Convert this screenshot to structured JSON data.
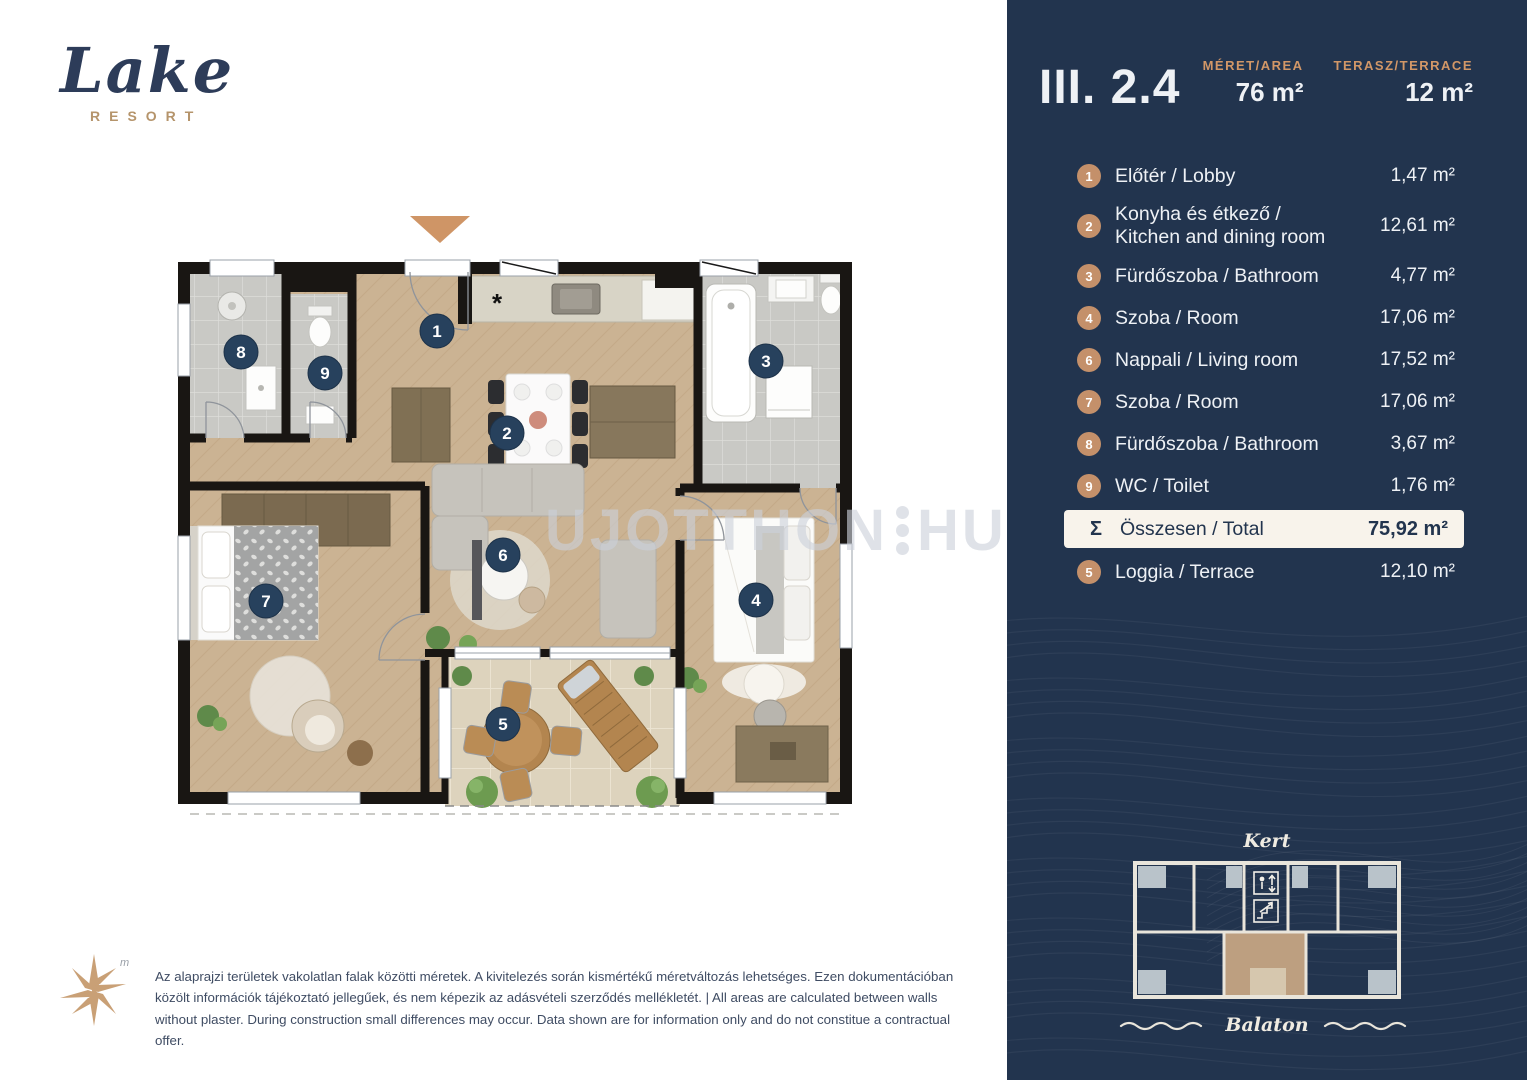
{
  "logo": {
    "name": "Lake",
    "subtitle": "RESORT"
  },
  "unit": {
    "id": "III. 2.4",
    "area_label": "MÉRET/AREA",
    "area_value": "76 m²",
    "terrace_label": "TERASZ/TERRACE",
    "terrace_value": "12 m²"
  },
  "rooms": [
    {
      "num": "1",
      "label": "Előtér / Lobby",
      "value": "1,47 m²"
    },
    {
      "num": "2",
      "label": "Konyha  és étkező /\nKitchen and dining room",
      "value": "12,61 m²",
      "two_line": true
    },
    {
      "num": "3",
      "label": "Fürdőszoba / Bathroom",
      "value": "4,77 m²"
    },
    {
      "num": "4",
      "label": "Szoba / Room",
      "value": "17,06 m²"
    },
    {
      "num": "6",
      "label": "Nappali / Living room",
      "value": "17,52 m²"
    },
    {
      "num": "7",
      "label": "Szoba / Room",
      "value": "17,06 m²"
    },
    {
      "num": "8",
      "label": "Fürdőszoba / Bathroom",
      "value": "3,67 m²"
    },
    {
      "num": "9",
      "label": "WC / Toilet",
      "value": "1,76 m²"
    },
    {
      "num": "Σ",
      "label": "Összesen / Total",
      "value": "75,92 m²",
      "total": true
    },
    {
      "num": "5",
      "label": "Loggia / Terrace",
      "value": "12,10 m²"
    }
  ],
  "floorplan": {
    "badges": [
      {
        "n": "1",
        "x": 267,
        "y": 83
      },
      {
        "n": "2",
        "x": 337,
        "y": 185
      },
      {
        "n": "3",
        "x": 596,
        "y": 113
      },
      {
        "n": "4",
        "x": 586,
        "y": 352
      },
      {
        "n": "5",
        "x": 333,
        "y": 476
      },
      {
        "n": "6",
        "x": 333,
        "y": 307
      },
      {
        "n": "7",
        "x": 96,
        "y": 353
      },
      {
        "n": "8",
        "x": 71,
        "y": 104
      },
      {
        "n": "9",
        "x": 155,
        "y": 125
      }
    ]
  },
  "watermark": {
    "text1": "UJOTTHON",
    "text2": "HU"
  },
  "minimap": {
    "top_label": "Kert",
    "bottom_label": "Balaton"
  },
  "compass": {
    "mark": "m"
  },
  "disclaimer": {
    "text": "Az alaprajzi területek vakolatlan falak közötti méretek. A kivitelezés során kismértékű méretváltozás lehetséges. Ezen dokumentációban közölt információk tájékoztató jellegűek, és nem képezik az adásvételi szerződés mellékletét. | All areas are calculated between walls without plaster. During construction small differences may occur. Data shown are for information only and do not constitue a contractual offer."
  },
  "colors": {
    "panel_navy": "#22344e",
    "badge_tan": "#c4906a",
    "header_accent": "#d29767",
    "total_row_bg": "#f8f3eb",
    "plan_badge_navy": "#27415d",
    "entrance_arrow": "#cf9566",
    "logo_navy": "#2d3c59",
    "logo_gold": "#b5946b",
    "minimap_highlight": "#bd9f80"
  }
}
